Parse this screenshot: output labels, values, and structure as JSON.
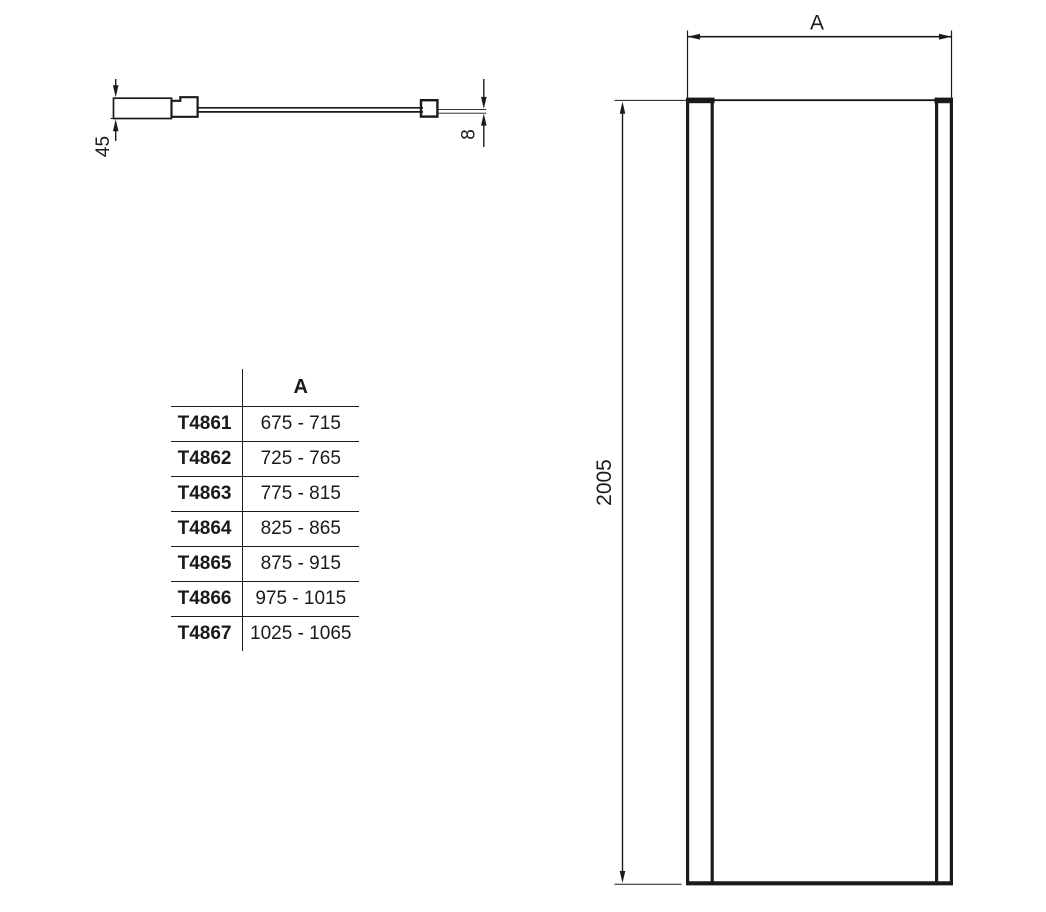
{
  "plan_view": {
    "dim_profile_width": "45",
    "dim_glass_thickness": "8"
  },
  "front_view": {
    "dim_width_label": "A",
    "dim_height": "2005"
  },
  "table": {
    "header_a": "A",
    "rows": [
      {
        "code": "T4861",
        "range": "675 - 715"
      },
      {
        "code": "T4862",
        "range": "725 - 765"
      },
      {
        "code": "T4863",
        "range": "775 - 815"
      },
      {
        "code": "T4864",
        "range": "825 - 865"
      },
      {
        "code": "T4865",
        "range": "875 - 915"
      },
      {
        "code": "T4866",
        "range": "975 - 1015"
      },
      {
        "code": "T4867",
        "range": "1025 - 1065"
      }
    ]
  },
  "colors": {
    "line": "#1a1a1a",
    "background": "#ffffff"
  }
}
